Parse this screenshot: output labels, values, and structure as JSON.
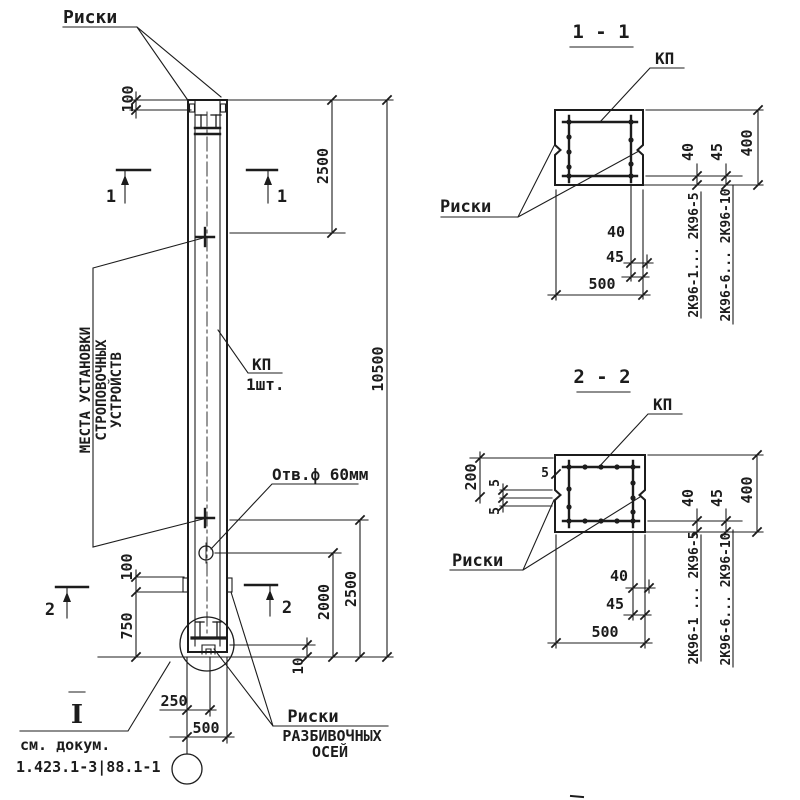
{
  "colors": {
    "ink": "#1c1c1c",
    "paper": "#ffffff"
  },
  "elevation": {
    "riski_top_label": "Риски",
    "strop_label_line1": "МЕСТА УСТАНОВКИ",
    "strop_label_line2": "СТРОПОВОЧНЫХ",
    "strop_label_line3": "УСТРОЙСТВ",
    "kp_label": "КП",
    "kp_qty": "1шт.",
    "hole_label": "Отв.ф 60мм",
    "riski_axes_line1": "Риски",
    "riski_axes_line2": "РАЗБИВОЧНЫХ",
    "riski_axes_line3": "ОСЕЙ",
    "detail_mark": "I",
    "see_doc_line1": "см. докум.",
    "see_doc_line2": "1.423.1-3|88.1-1",
    "cut1_left": "1",
    "cut1_right": "1",
    "cut2_left": "2",
    "cut2_right": "2",
    "dims": {
      "top_100": "100",
      "top_2500": "2500",
      "overall_10500": "10500",
      "bot_2500": "2500",
      "bot_2000": "2000",
      "bot_10": "10",
      "left_100": "100",
      "left_750": "750",
      "base_250": "250",
      "base_500": "500"
    }
  },
  "section_1_1": {
    "title": "1 - 1",
    "kp_label": "КП",
    "riski_label": "Риски",
    "marks_range_1": "2К96-1... 2К96-5",
    "marks_range_2": "2К96-6... 2К96-10",
    "dims": {
      "right_40": "40",
      "right_45": "45",
      "right_400": "400",
      "bottom_40": "40",
      "bottom_45": "45",
      "bottom_500": "500"
    }
  },
  "section_2_2": {
    "title": "2 - 2",
    "kp_label": "КП",
    "riski_label": "Риски",
    "marks_range_1": "2К96-1 ... 2К96-5",
    "marks_range_2": "2К96-6... 2К96-10",
    "dims": {
      "left_200": "200",
      "left_5a": "5",
      "left_5b": "5",
      "left_5c": "5",
      "right_40": "40",
      "right_45": "45",
      "right_400": "400",
      "bottom_40": "40",
      "bottom_45": "45",
      "bottom_500": "500"
    }
  }
}
